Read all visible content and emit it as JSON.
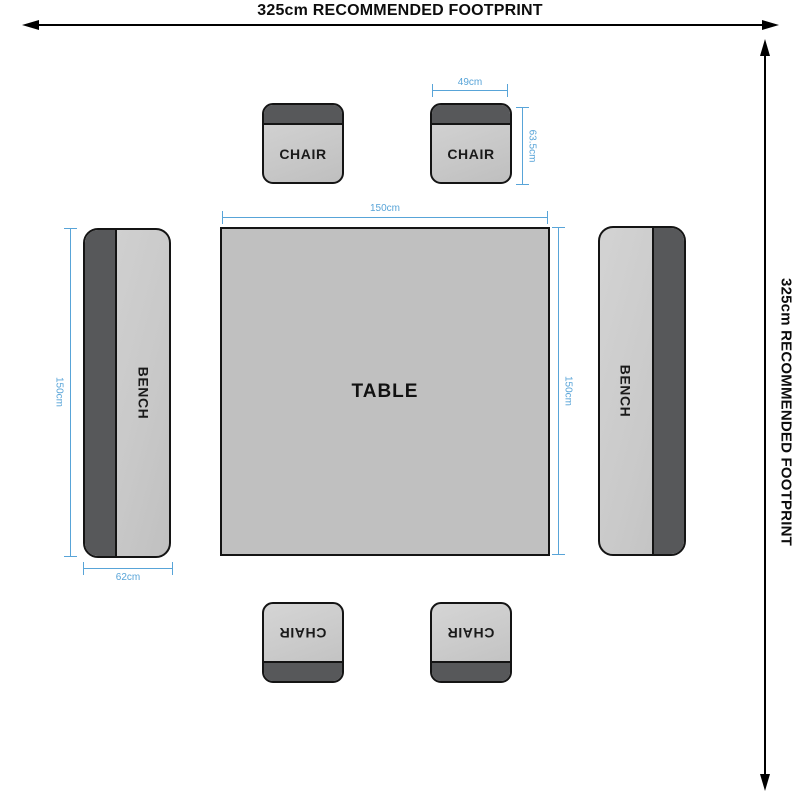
{
  "diagram": {
    "footprint": {
      "width_label": "325cm RECOMMENDED FOOTPRINT",
      "height_label": "325cm RECOMMENDED FOOTPRINT"
    },
    "table": {
      "label": "TABLE"
    },
    "chairs": [
      {
        "position": "top-left",
        "label": "CHAIR"
      },
      {
        "position": "top-right",
        "label": "CHAIR"
      },
      {
        "position": "bottom-left",
        "label": "CHAIR"
      },
      {
        "position": "bottom-right",
        "label": "CHAIR"
      }
    ],
    "benches": [
      {
        "position": "left",
        "label": "BENCH"
      },
      {
        "position": "right",
        "label": "BENCH"
      }
    ],
    "dims": {
      "chair_width": "49cm",
      "chair_height": "63.5cm",
      "table_width": "150cm",
      "table_height": "150cm",
      "bench_length": "150cm",
      "bench_width": "62cm"
    },
    "colors": {
      "dimension_blue": "#58a4d8",
      "furniture_light": "#c9c9c9",
      "furniture_dark": "#57585a",
      "table_fill": "#c0c0c0",
      "outline_black": "#141414"
    }
  }
}
